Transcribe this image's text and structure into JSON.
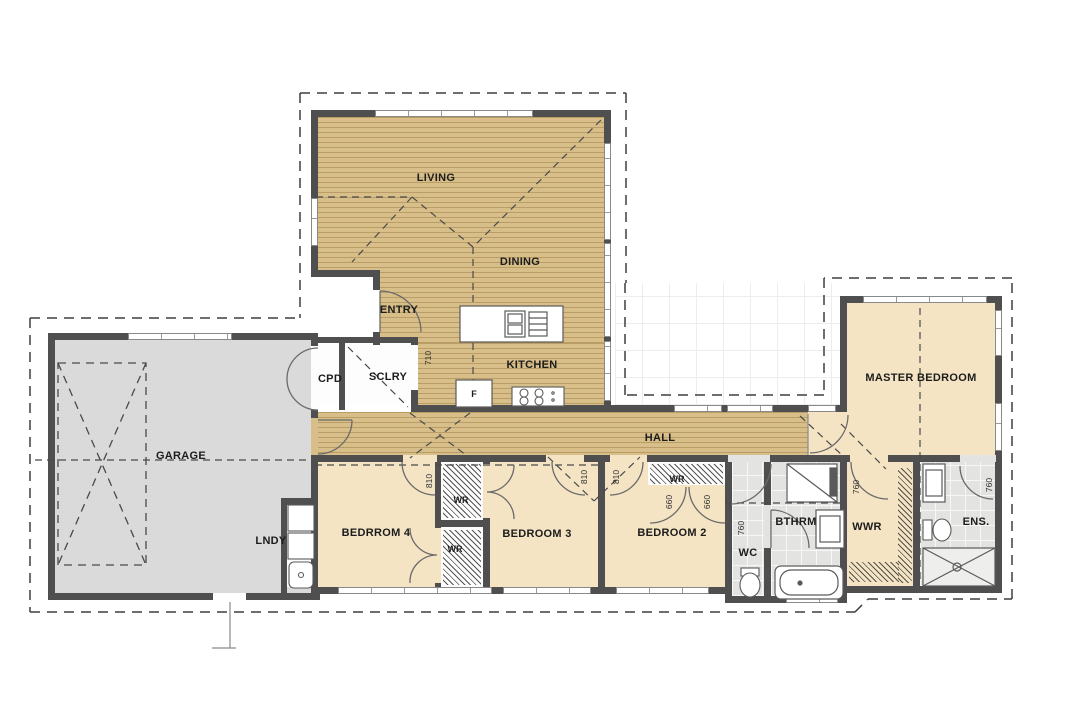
{
  "title": "house-floor-plan",
  "labels": {
    "living": "LIVING",
    "dining": "DINING",
    "entry": "ENTRY",
    "cpd": "CPD",
    "sclry": "SCLRY",
    "kitchen": "KITCHEN",
    "fridge": "F",
    "garage": "GARAGE",
    "lndy": "LNDY",
    "hall": "HALL",
    "bed4": "BEDRROM 4",
    "wr_bed3": "WR",
    "wr_bed4": "WR",
    "wr_bed2": "WR",
    "bed3": "BEDROOM 3",
    "bed2": "BEDROOM 2",
    "wc": "WC",
    "bthrm": "BTHRM",
    "wwr": "WWR",
    "ens": "ENS.",
    "master": "MASTER BEDROOM"
  },
  "dimensions": {
    "sclry_kitchen_opening": "710",
    "bed4_door": "810",
    "bed3_door": "810",
    "bed2_door": "810",
    "bed2_wr_door_left": "660",
    "bed2_wr_door_right": "660",
    "wc_door": "760",
    "wwr_door": "760",
    "ens_door": "760"
  },
  "colors": {
    "wood": "#d8bf8a",
    "wood_stripe": "#b89c66",
    "cream": "#f4e4c4",
    "garage": "#dadada",
    "tile": "#e3e3e1",
    "wall": "#4f4f4f",
    "dash": "#3f3f3f"
  }
}
